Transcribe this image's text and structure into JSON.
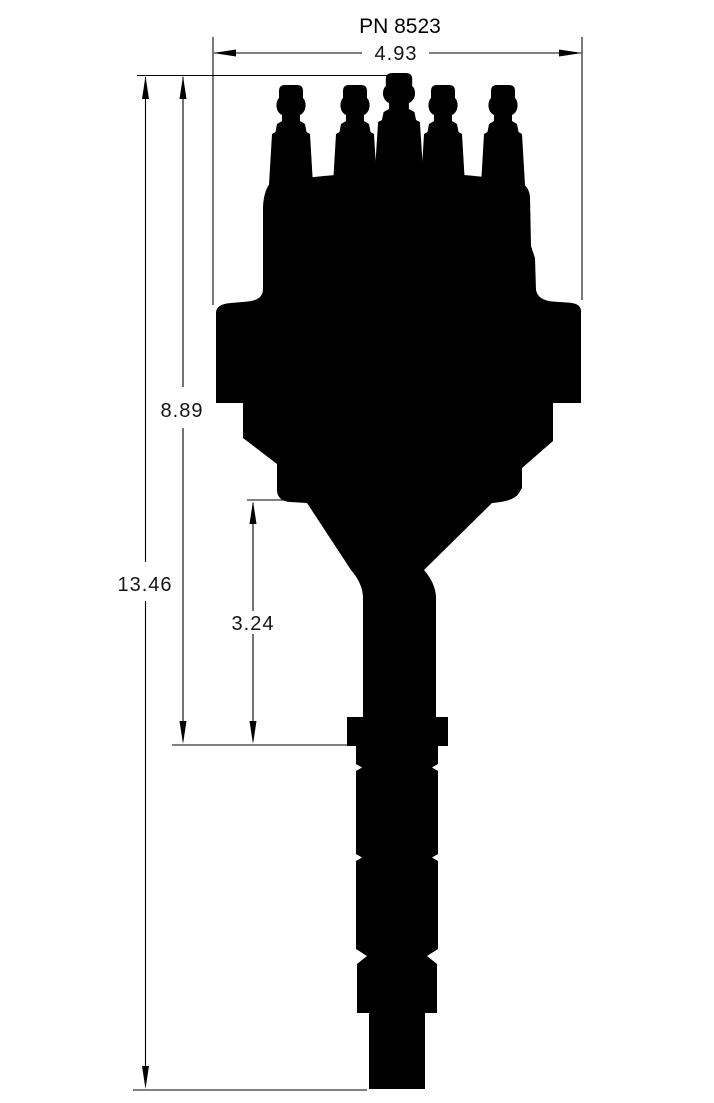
{
  "drawing": {
    "title": "PN 8523",
    "subject": "distributor-side-profile-silhouette",
    "colors": {
      "ink": "#000000",
      "paper": "#ffffff"
    },
    "dimensions": {
      "overall_width": "4.93",
      "total_height": "13.46",
      "upper_height": "8.89",
      "lower_height": "3.24"
    }
  }
}
